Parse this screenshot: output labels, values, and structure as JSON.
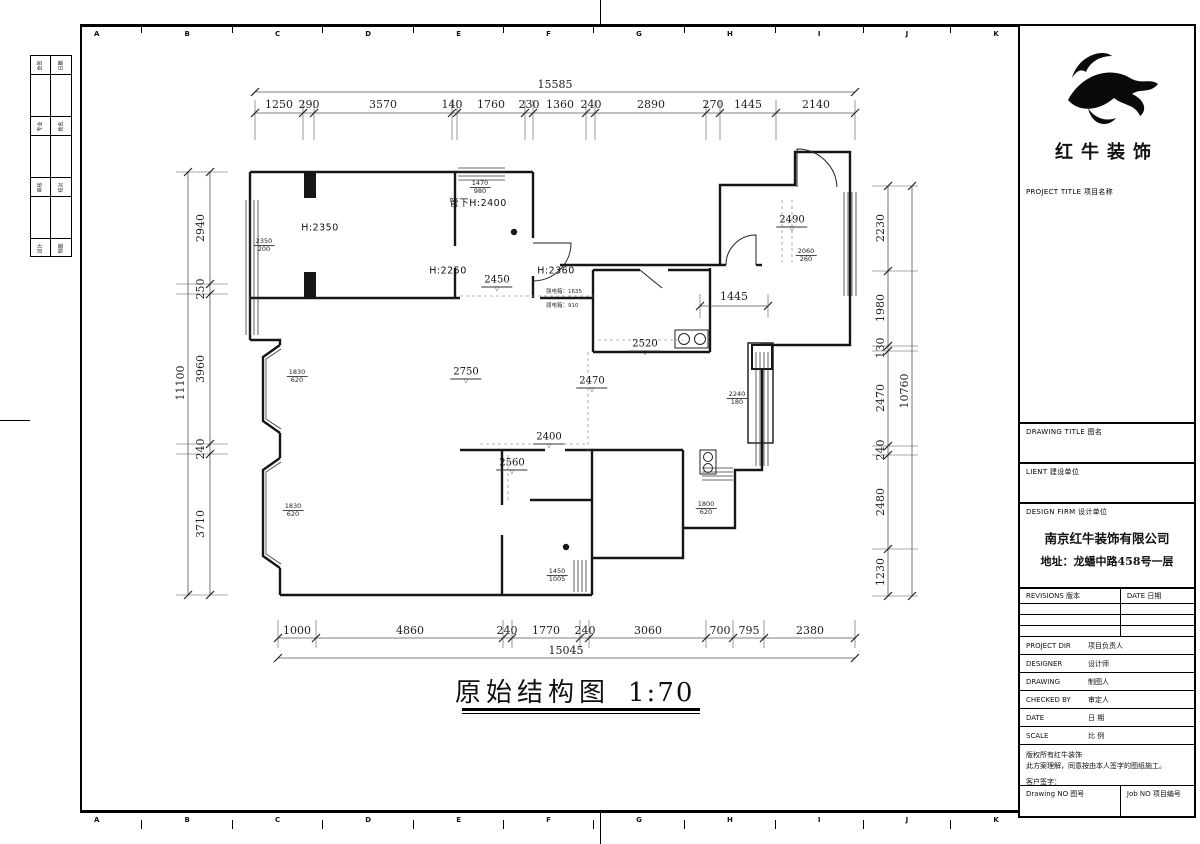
{
  "sheet": {
    "grid_letters": [
      "A",
      "B",
      "C",
      "D",
      "E",
      "F",
      "G",
      "H",
      "I",
      "J",
      "K"
    ],
    "title": "原始结构图",
    "scale_label": "1:70"
  },
  "dims": {
    "top": {
      "total": "15585",
      "segments": [
        "1250",
        "290",
        "3570",
        "140",
        "1760",
        "230",
        "1360",
        "240",
        "2890",
        "270",
        "1445",
        "2140"
      ]
    },
    "bottom": {
      "total": "15045",
      "segments": [
        "1000",
        "4860",
        "240",
        "1770",
        "240",
        "3060",
        "700",
        "795",
        "2380"
      ]
    },
    "left": {
      "total": "11100",
      "segments": [
        "2940",
        "250",
        "3960",
        "240",
        "3710"
      ]
    },
    "right": {
      "total": "10760",
      "segments": [
        "2230",
        "1980",
        "130",
        "2470",
        "240",
        "2480",
        "1230"
      ]
    },
    "inner_1445": "1445"
  },
  "plan": {
    "heights": {
      "h2350": "H:2350",
      "h2250": "H:2250",
      "h2360": "H:2360",
      "duct": "管下H:2400"
    },
    "levels": {
      "l2450": "2450",
      "l2490": "2490",
      "l2520": "2520",
      "l2750": "2750",
      "l2470": "2470",
      "l2400": "2400",
      "l2560": "2560"
    },
    "fracs": {
      "f1": {
        "n": "1470",
        "d": "980"
      },
      "f2": {
        "n": "2350",
        "d": "200"
      },
      "f3": {
        "n": "2060",
        "d": "260"
      },
      "f4": {
        "n": "2240",
        "d": "180"
      },
      "f5": {
        "n": "1830",
        "d": "620"
      },
      "f6": {
        "n": "1800",
        "d": "620"
      },
      "f7": {
        "n": "1450",
        "d": "1005"
      }
    },
    "elec": {
      "strong": "强电箱：1635",
      "weak": "弱电箱：910"
    },
    "tri": "▽"
  },
  "titleblock": {
    "brand": "红牛装饰",
    "project_title": "PROJECT TITLE   项目名称",
    "drawing_title": "DRAWING TITLE   图名",
    "client": "LIENT 建设单位",
    "design_firm": "DESIGN FIRM   设计单位",
    "company": "南京红牛装饰有限公司",
    "address": "地址：龙蟠中路458号一层",
    "revisions": "REVISIONS 版本",
    "date_col": "DATE 日期",
    "rows": [
      {
        "en": "PROJECT DIR",
        "cn": "项目负责人"
      },
      {
        "en": "DESIGNER",
        "cn": "设计师"
      },
      {
        "en": "DRAWING",
        "cn": "制图人"
      },
      {
        "en": "CHECKED BY",
        "cn": "审定人"
      },
      {
        "en": "DATE",
        "cn": "日  期"
      },
      {
        "en": "SCALE",
        "cn": "比  例"
      }
    ],
    "copyright1": "版权所有红牛装饰",
    "copyright2": "此方案理解，同意按由本人签字的图纸施工。",
    "signature": "客户签字：",
    "drawing_no": "Drawing NO 图号",
    "job_no": "Job NO 项目编号"
  },
  "side_table": {
    "rows": [
      [
        "会签",
        "日期"
      ],
      [
        "专业",
        "姓名"
      ],
      [
        "审核",
        "校对"
      ],
      [
        "设计",
        "制图"
      ]
    ]
  }
}
